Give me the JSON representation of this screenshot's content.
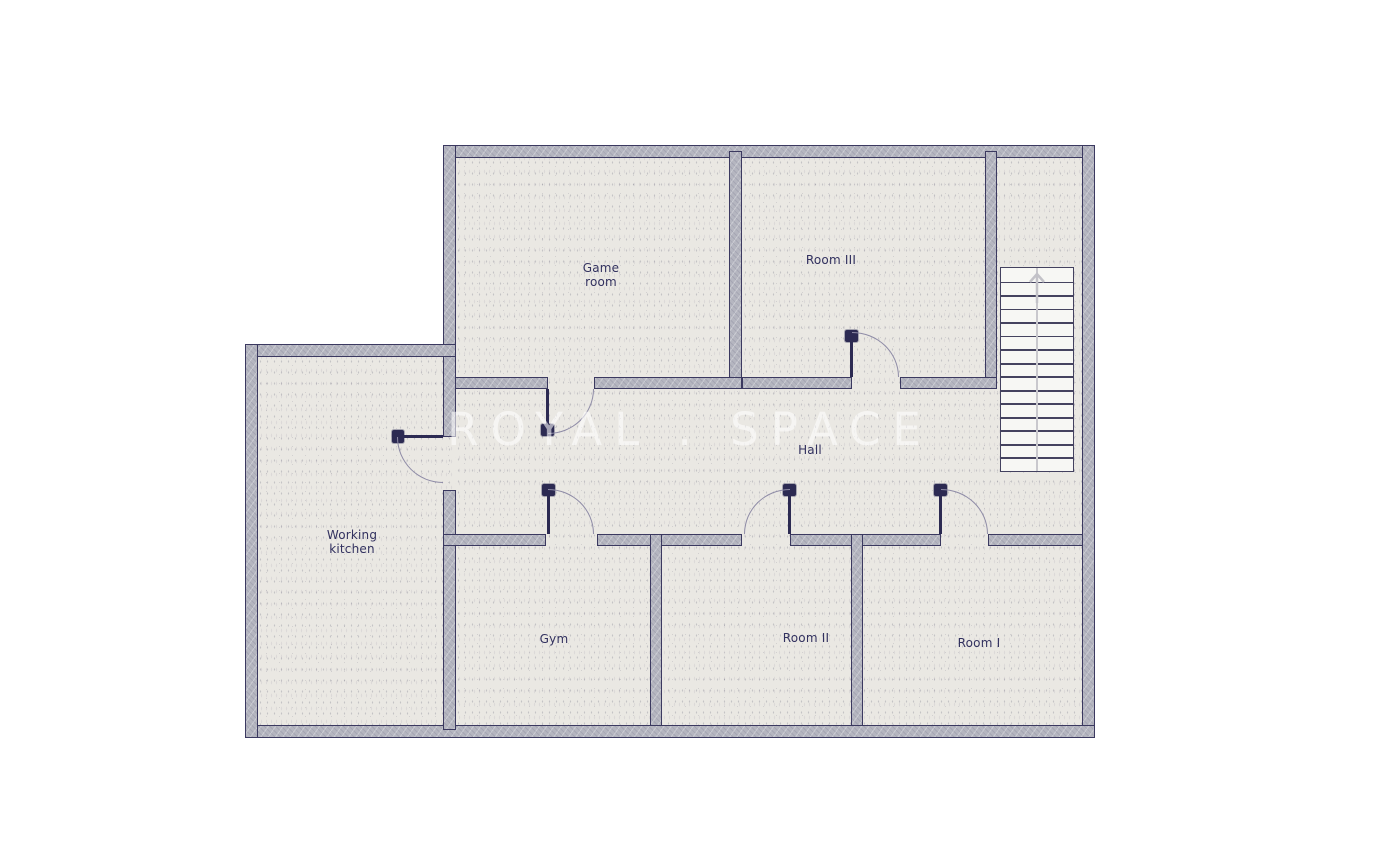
{
  "watermark": {
    "text": "ROYAL . SPACE"
  },
  "rooms": {
    "game_room": {
      "line1": "Game",
      "line2": "room"
    },
    "room_iii": {
      "name": "Room III"
    },
    "working_kitchen": {
      "line1": "Working",
      "line2": "kitchen"
    },
    "hall": {
      "name": "Hall"
    },
    "gym": {
      "name": "Gym"
    },
    "room_ii": {
      "name": "Room II"
    },
    "room_i": {
      "name": "Room I"
    },
    "clipped_label": {
      "line1": "a",
      "line2": "o"
    }
  },
  "stairs": {
    "steps": 15,
    "direction": "up"
  },
  "colors": {
    "wall_fill": "#b5b6c0",
    "wall_line": "#3b3960",
    "floor": "#eae8e3",
    "label_text": "#32315f",
    "door": "#2c2a52",
    "door_arc": "#8e8ba6",
    "stair_bg": "#f7f7f4",
    "stair_line": "#45435f",
    "watermark": "#ffffff"
  }
}
